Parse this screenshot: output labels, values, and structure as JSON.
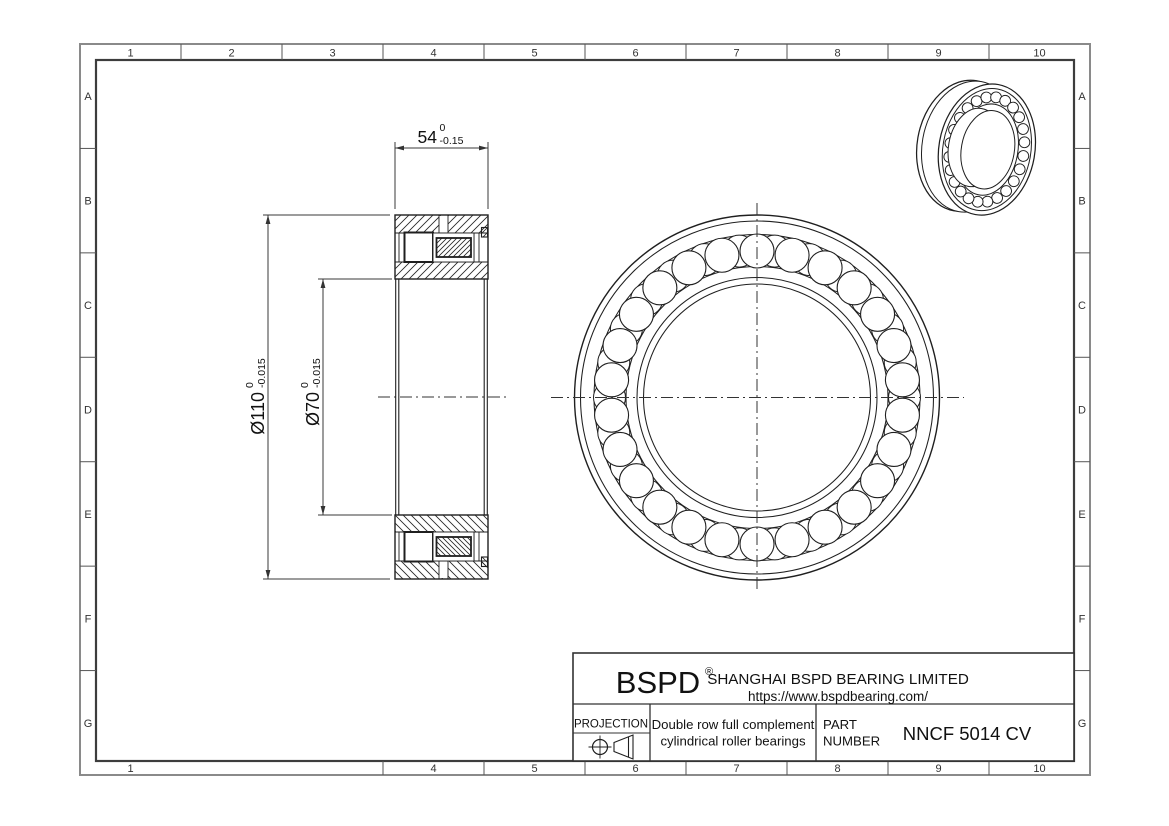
{
  "drawing": {
    "grid": {
      "top_columns": [
        "1",
        "2",
        "3",
        "4",
        "5",
        "6",
        "7",
        "8",
        "9",
        "10"
      ],
      "bottom_columns": [
        "1",
        "",
        "",
        "4",
        "5",
        "6",
        "7",
        "8",
        "9",
        "10"
      ],
      "left_rows": [
        "A",
        "B",
        "C",
        "D",
        "E",
        "F",
        "G"
      ],
      "right_rows": [
        "A",
        "B",
        "C",
        "D",
        "E",
        "F",
        "G"
      ]
    },
    "dimensions": {
      "width": {
        "value": "54",
        "tol_upper": "0",
        "tol_lower": "-0.15"
      },
      "outer_diameter": {
        "value": "Ø110",
        "tol_upper": "0",
        "tol_lower": "-0.015"
      },
      "bore_diameter": {
        "value": "Ø70",
        "tol_upper": "0",
        "tol_lower": "-0.015"
      }
    },
    "title_block": {
      "logo": "BSPD",
      "registered_mark": "®",
      "company": "SHANGHAI BSPD BEARING LIMITED",
      "website": "https://www.bspdbearing.com/",
      "projection_label": "PROJECTION",
      "description_line1": "Double row full complement",
      "description_line2": "cylindrical roller bearings",
      "part_label_line1": "PART",
      "part_label_line2": "NUMBER",
      "part_number": "NNCF 5014 CV"
    },
    "colors": {
      "line": "#1f1f1f",
      "dim_line": "#3a3a3a",
      "border_outer": "#8a8a8a",
      "border_inner": "#3d3d3d"
    }
  }
}
